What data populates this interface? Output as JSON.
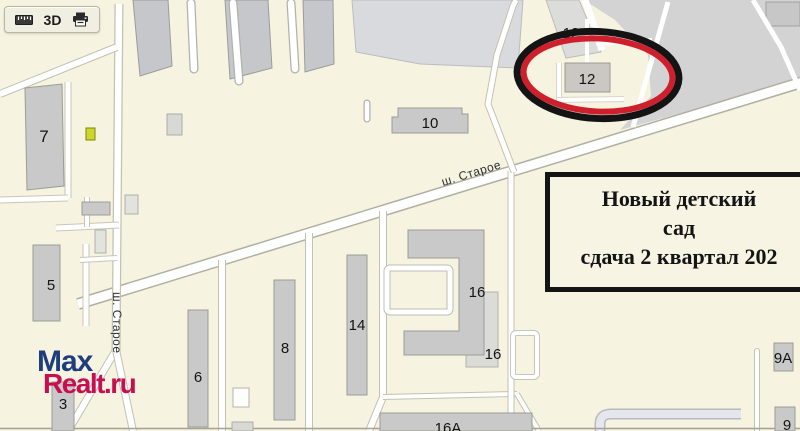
{
  "toolbar": {
    "mode_3d_label": "3D",
    "icons": [
      "ruler-icon",
      "printer-icon"
    ]
  },
  "map": {
    "streets": {
      "main_road": "ш. Старое",
      "side_street": "ш. Старое"
    },
    "building_labels": {
      "b7": "7",
      "b5": "5",
      "b3": "3",
      "b6": "6",
      "b8": "8",
      "b14": "14",
      "b10": "10",
      "b16_upper": "16",
      "b16_lower": "16",
      "b16a": "16А",
      "b12_top": "12",
      "b12_main": "12",
      "b9a": "9А",
      "b9": "9"
    },
    "highlight": {
      "shape": "ellipse",
      "outer_color": "#141414",
      "inner_color": "#ce1f2d",
      "highlighted_building": "12"
    },
    "colors": {
      "map_background": "#f7f3e1",
      "building_fill": "#c9c9c9",
      "road_fill": "#ffffff",
      "industrial_zone": "#d3d3d4"
    }
  },
  "annotation": {
    "lines": [
      "Новый детский",
      "сад",
      "сдача 2 квартал 202"
    ]
  },
  "watermark": {
    "line1": "Max",
    "line2": "Realt.ru",
    "line1_color": "#1d3e7c",
    "line2_color": "#c60f50"
  }
}
